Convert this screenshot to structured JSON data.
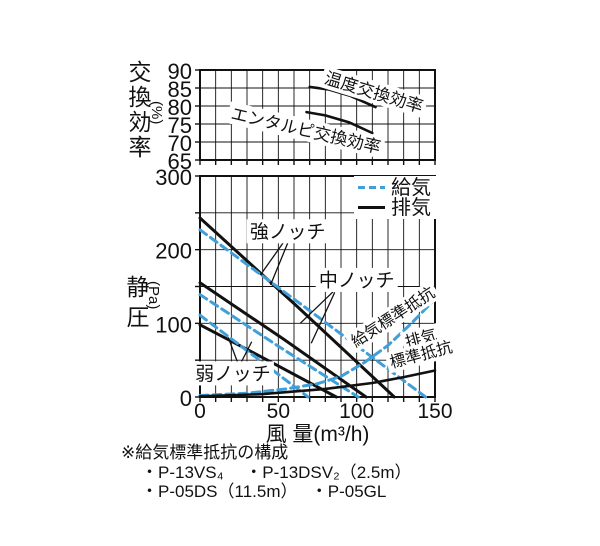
{
  "colors": {
    "ink": "#111111",
    "supply_blue": "#3f9fd8",
    "background": "#ffffff"
  },
  "footnote": {
    "title": "※給気標準抵抗の構成",
    "line1": "・P-13VS₄　 ・P-13DSV₂（2.5m）",
    "line2": "・P-05DS（11.5m）　 ・P-05GL"
  },
  "chart_data": [
    {
      "id": "efficiency",
      "type": "line",
      "title": "",
      "xlabel": "",
      "ylabel": "交換効率",
      "ylabel_unit": "(%)",
      "xlim": [
        0,
        150
      ],
      "ylim": [
        65,
        90
      ],
      "x_grid_step": 10,
      "y_grid_step": 5,
      "grid": "on",
      "xticks": [],
      "yticks": [
        90,
        85,
        80,
        75,
        70,
        65
      ],
      "series": [
        {
          "name": "温度交換効率",
          "style": "solid",
          "points": [
            [
              70,
              85.3
            ],
            [
              82,
              84.6
            ],
            [
              96,
              82.8
            ],
            [
              112,
              79.7
            ]
          ]
        },
        {
          "name": "エンタルピ交換効率",
          "style": "solid",
          "points": [
            [
              68,
              78.3
            ],
            [
              80,
              77.4
            ],
            [
              95,
              75.5
            ],
            [
              110,
              72.5
            ]
          ]
        }
      ],
      "annotations": [
        {
          "text": "温度交換効率",
          "xy": [
            111,
            83.9
          ],
          "rotate": 17
        },
        {
          "text": "エンタルピ交換効率",
          "xy": [
            67.6,
            73.3
          ],
          "rotate": 13
        }
      ]
    },
    {
      "id": "pq",
      "type": "line",
      "title": "",
      "xlabel": "風 量(m³/h)",
      "ylabel": "静圧",
      "ylabel_unit": "(Pa)",
      "xlim": [
        0,
        150
      ],
      "ylim": [
        0,
        300
      ],
      "x_grid_step": 10,
      "y_grid_step": 50,
      "grid": "on",
      "xticks": [
        0,
        50,
        100,
        150
      ],
      "yticks": [
        300,
        200,
        100,
        0
      ],
      "legend": [
        {
          "label": "給気",
          "style": "dashed"
        },
        {
          "label": "排気",
          "style": "solid"
        }
      ],
      "legend_position": "top-right",
      "series": [
        {
          "name": "強ノッチ 排気",
          "style": "solid",
          "points": [
            [
              0,
              243
            ],
            [
              62,
              123
            ],
            [
              124,
              0
            ]
          ]
        },
        {
          "name": "強ノッチ 給気",
          "style": "dashed",
          "points": [
            [
              0,
              227
            ],
            [
              72,
              114
            ],
            [
              144,
              0
            ]
          ]
        },
        {
          "name": "中ノッチ 排気",
          "style": "solid",
          "points": [
            [
              0,
              155
            ],
            [
              53,
              79
            ],
            [
              106,
              0
            ]
          ]
        },
        {
          "name": "中ノッチ 給気",
          "style": "dashed",
          "points": [
            [
              0,
              139
            ],
            [
              50,
              69
            ],
            [
              101,
              0
            ]
          ]
        },
        {
          "name": "弱ノッチ 排気",
          "style": "solid",
          "points": [
            [
              0,
              98
            ],
            [
              44,
              49
            ],
            [
              87,
              0
            ]
          ]
        },
        {
          "name": "弱ノッチ 給気",
          "style": "dashed",
          "points": [
            [
              0,
              111
            ],
            [
              35,
              55
            ],
            [
              69,
              0
            ]
          ]
        },
        {
          "name": "給気標準抵抗",
          "style": "dashed",
          "points": [
            [
              0,
              2
            ],
            [
              30,
              5
            ],
            [
              55,
              11
            ],
            [
              75,
              18
            ],
            [
              90,
              28
            ],
            [
              105,
              47
            ],
            [
              120,
              70
            ],
            [
              135,
              100
            ],
            [
              150,
              133
            ]
          ]
        },
        {
          "name": "排気標準抵抗",
          "style": "solid",
          "points": [
            [
              0,
              1
            ],
            [
              40,
              4
            ],
            [
              80,
              11
            ],
            [
              110,
              19
            ],
            [
              130,
              27
            ],
            [
              150,
              36
            ]
          ]
        }
      ],
      "annotations": [
        {
          "text": "強ノッチ",
          "xy": [
            56,
            225
          ],
          "rotate": 0,
          "leaders": [
            [
              [
                53,
                209
              ],
              [
                40,
                170
              ]
            ],
            [
              [
                56,
                209
              ],
              [
                45,
                152
              ]
            ]
          ]
        },
        {
          "text": "中ノッチ",
          "xy": [
            100,
            159
          ],
          "rotate": 0,
          "leaders": [
            [
              [
                85,
                143
              ],
              [
                64,
                100
              ]
            ],
            [
              [
                86,
                142
              ],
              [
                71,
                73
              ]
            ]
          ]
        },
        {
          "text": "弱ノッチ",
          "xy": [
            21,
            32
          ],
          "rotate": 0,
          "leaders": [
            [
              [
                24,
                47
              ],
              [
                18,
                81
              ]
            ],
            [
              [
                26,
                46
              ],
              [
                33,
                75
              ]
            ]
          ]
        },
        {
          "text": "給気標準抵抗",
          "xy": [
            123,
            109
          ],
          "rotate": -33
        },
        {
          "text": "排気",
          "xy": [
            141,
            80
          ],
          "rotate": -15
        },
        {
          "text": "標準抵抗",
          "xy": [
            141,
            58
          ],
          "rotate": -15
        }
      ]
    }
  ]
}
